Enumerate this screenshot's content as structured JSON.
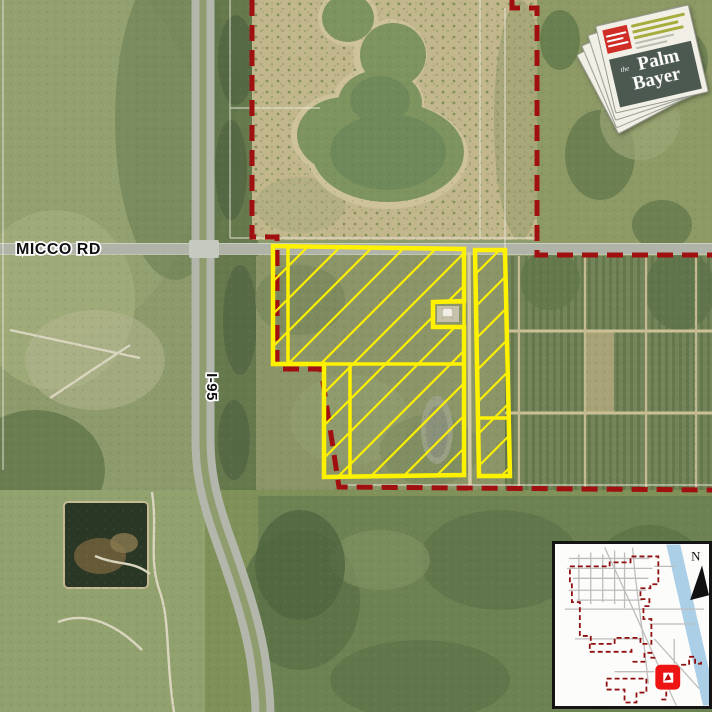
{
  "map": {
    "labels": {
      "micco_rd": "MICCO RD",
      "i95": "I-95"
    }
  },
  "logo": {
    "prefix": "the",
    "name_line1": "Palm",
    "name_line2": "Bayer"
  },
  "inset": {
    "north_label": "N"
  },
  "colors": {
    "boundary_red": "#a01010",
    "parcel_yellow": "#fff200",
    "water_blue": "#abcfe6",
    "inset_boundary_red": "#8f1010",
    "marker_red": "#ee1414",
    "masthead_bg": "#4c5951",
    "newspaper_red": "#cf2d26",
    "newspaper_olive": "#a6ac3e"
  }
}
